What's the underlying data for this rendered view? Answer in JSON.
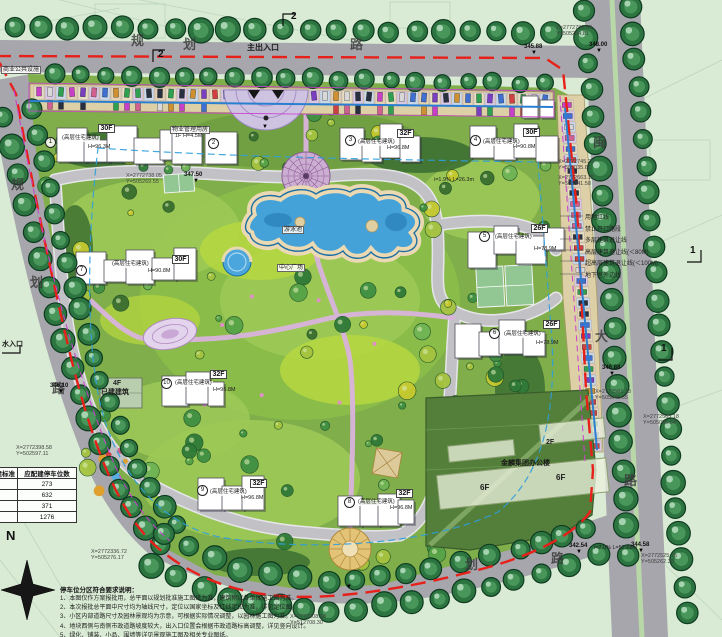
{
  "colors": {
    "boundary_red": "#e8201a",
    "water_blue": "#45a2d8",
    "lawn_green": "#7fae4a",
    "road_gray": "#a6a6ac",
    "tree_green": "#2c7440",
    "path_pink": "#d9b3dc",
    "parcel_green": "#547f3b",
    "setback_blue": "#2f9fdc",
    "magenta_line": "#cc3fd0"
  },
  "legend": {
    "items": [
      "用地红线",
      "禁止开口路段",
      "多层建筑退让线",
      "高层建筑退让线(＜80M)",
      "超高层建筑退让线(＜100M)",
      "地下室外边线"
    ]
  },
  "table": {
    "headers": [
      "配建标准",
      "应配建停车位数"
    ],
    "rows": [
      "273",
      "632",
      "371",
      "1276"
    ]
  },
  "north": {
    "label": "N"
  },
  "notes": {
    "title": "停车位分区符合要求说明：",
    "items": [
      "1、本图仅作方案报批用，总平面以规划批准施工图纸为准，建筑物以各单体施工图为准。",
      "2、本次报批总平面中尺寸均为轴线尺寸，定位以国家坐标及红线定位为准，详见定位图。",
      "3、小区内部道路尺寸及园林景观均为示意，可根据实际情况调整，以园林施工图为准。",
      "4、地块西侧与南侧市政道路坡度较大，出入口位置会根据市政道路标高调整，详见竖向设计。",
      "5、绿化、铺装、小品、围墙等详见景观施工图及相关专业图纸。"
    ]
  },
  "annotations": [
    {
      "t": "规",
      "x": 131,
      "y": 34,
      "c": "char"
    },
    {
      "t": "划",
      "x": 183,
      "y": 38,
      "c": "char"
    },
    {
      "t": "路",
      "x": 350,
      "y": 38,
      "c": "char"
    },
    {
      "t": "规",
      "x": 11,
      "y": 178,
      "c": "char"
    },
    {
      "t": "划",
      "x": 30,
      "y": 276,
      "c": "char"
    },
    {
      "t": "路",
      "x": 52,
      "y": 382,
      "c": "char"
    },
    {
      "t": "闽",
      "x": 593,
      "y": 136,
      "c": "char"
    },
    {
      "t": "大",
      "x": 595,
      "y": 330,
      "c": "char"
    },
    {
      "t": "路",
      "x": 624,
      "y": 474,
      "c": "char"
    },
    {
      "t": "划",
      "x": 465,
      "y": 558,
      "c": "char"
    },
    {
      "t": "路",
      "x": 551,
      "y": 552,
      "c": "char"
    },
    {
      "t": "主出入口",
      "x": 247,
      "y": 44,
      "c": "lab8"
    },
    {
      "t": "水入口",
      "x": 2,
      "y": 341,
      "c": "lab7"
    },
    {
      "t": "商业公共设施",
      "x": 1,
      "y": 66,
      "c": "wl"
    },
    {
      "t": "物业管理用房",
      "x": 170,
      "y": 126,
      "c": "wl"
    },
    {
      "t": "1F H=4.5M",
      "x": 175,
      "y": 134,
      "c": "tiny"
    },
    {
      "t": "游泳池",
      "x": 282,
      "y": 226,
      "c": "wl"
    },
    {
      "t": "中心广场",
      "x": 277,
      "y": 264,
      "c": "wl"
    },
    {
      "t": "已建建筑",
      "x": 101,
      "y": 389,
      "c": "tiny7"
    },
    {
      "t": "4F",
      "x": 113,
      "y": 380,
      "c": "tiny7"
    },
    {
      "t": "2F",
      "x": 546,
      "y": 439,
      "c": "tiny7"
    },
    {
      "t": "金麟集团办公楼",
      "x": 501,
      "y": 460,
      "c": "lab7"
    },
    {
      "t": "6F",
      "x": 556,
      "y": 474,
      "c": "lab8"
    },
    {
      "t": "6F",
      "x": 480,
      "y": 484,
      "c": "lab8"
    },
    {
      "t": "1",
      "x": 45,
      "y": 137,
      "c": "circ"
    },
    {
      "t": "2",
      "x": 208,
      "y": 138,
      "c": "circ"
    },
    {
      "t": "3",
      "x": 345,
      "y": 135,
      "c": "circ"
    },
    {
      "t": "4",
      "x": 470,
      "y": 135,
      "c": "circ"
    },
    {
      "t": "5",
      "x": 479,
      "y": 231,
      "c": "circ"
    },
    {
      "t": "6",
      "x": 489,
      "y": 328,
      "c": "circ"
    },
    {
      "t": "7",
      "x": 76,
      "y": 265,
      "c": "circ"
    },
    {
      "t": "10",
      "x": 161,
      "y": 378,
      "c": "circ"
    },
    {
      "t": "9",
      "x": 197,
      "y": 485,
      "c": "circ"
    },
    {
      "t": "8",
      "x": 344,
      "y": 497,
      "c": "circ"
    },
    {
      "t": "30F",
      "x": 98,
      "y": 124,
      "c": "box"
    },
    {
      "t": "32F",
      "x": 397,
      "y": 129,
      "c": "box"
    },
    {
      "t": "30F",
      "x": 523,
      "y": 128,
      "c": "box"
    },
    {
      "t": "26F",
      "x": 531,
      "y": 224,
      "c": "box"
    },
    {
      "t": "26F",
      "x": 543,
      "y": 320,
      "c": "box"
    },
    {
      "t": "30F",
      "x": 172,
      "y": 255,
      "c": "box"
    },
    {
      "t": "32F",
      "x": 210,
      "y": 370,
      "c": "box"
    },
    {
      "t": "32F",
      "x": 250,
      "y": 479,
      "c": "box"
    },
    {
      "t": "32F",
      "x": 396,
      "y": 489,
      "c": "box"
    },
    {
      "t": "(高层住宅建筑)",
      "x": 61,
      "y": 136,
      "c": "t55"
    },
    {
      "t": "(高层住宅建筑)",
      "x": 357,
      "y": 140,
      "c": "t55"
    },
    {
      "t": "(高层住宅建筑)",
      "x": 482,
      "y": 140,
      "c": "t55"
    },
    {
      "t": "(高层住宅建筑)",
      "x": 494,
      "y": 235,
      "c": "t55"
    },
    {
      "t": "(高层住宅建筑)",
      "x": 503,
      "y": 332,
      "c": "t55"
    },
    {
      "t": "(高层住宅建筑)",
      "x": 111,
      "y": 262,
      "c": "t55"
    },
    {
      "t": "(高层住宅建筑)",
      "x": 174,
      "y": 381,
      "c": "t55"
    },
    {
      "t": "(高层住宅建筑)",
      "x": 209,
      "y": 490,
      "c": "t55"
    },
    {
      "t": "(高层住宅建筑)",
      "x": 357,
      "y": 500,
      "c": "t55"
    },
    {
      "t": "H=96.3M",
      "x": 88,
      "y": 145,
      "c": "tiny"
    },
    {
      "t": "H=96.8M",
      "x": 387,
      "y": 146,
      "c": "tiny"
    },
    {
      "t": "H=90.8M",
      "x": 513,
      "y": 145,
      "c": "tiny"
    },
    {
      "t": "H=78.9M",
      "x": 534,
      "y": 247,
      "c": "tiny"
    },
    {
      "t": "H=78.9M",
      "x": 536,
      "y": 341,
      "c": "tiny"
    },
    {
      "t": "H=90.8M",
      "x": 148,
      "y": 269,
      "c": "tiny"
    },
    {
      "t": "H=96.8M",
      "x": 213,
      "y": 388,
      "c": "tiny"
    },
    {
      "t": "H=96.8M",
      "x": 241,
      "y": 496,
      "c": "tiny"
    },
    {
      "t": "H=96.8M",
      "x": 390,
      "y": 506,
      "c": "tiny"
    },
    {
      "t": "X=2772738.05",
      "x": 126,
      "y": 174,
      "c": "coord"
    },
    {
      "t": "Y=505269.55",
      "x": 126,
      "y": 180,
      "c": "coord"
    },
    {
      "t": "X=2772780.63",
      "x": 556,
      "y": 26,
      "c": "coord"
    },
    {
      "t": "Y=505284.81",
      "x": 556,
      "y": 32,
      "c": "coord"
    },
    {
      "t": "X=2772745.22",
      "x": 558,
      "y": 160,
      "c": "coord"
    },
    {
      "t": "Y=505035.61",
      "x": 558,
      "y": 166,
      "c": "coord"
    },
    {
      "t": "X=2772663.12",
      "x": 558,
      "y": 176,
      "c": "coord"
    },
    {
      "t": "Y=505041.58",
      "x": 558,
      "y": 182,
      "c": "coord"
    },
    {
      "t": "X=2772581.33",
      "x": 595,
      "y": 390,
      "c": "coord"
    },
    {
      "t": "Y=505045.35",
      "x": 595,
      "y": 396,
      "c": "coord"
    },
    {
      "t": "X=2772563.18",
      "x": 643,
      "y": 415,
      "c": "coord"
    },
    {
      "t": "Y=505050.64",
      "x": 643,
      "y": 421,
      "c": "coord"
    },
    {
      "t": "X=2772398.58",
      "x": 16,
      "y": 446,
      "c": "coord"
    },
    {
      "t": "Y=502597.11",
      "x": 16,
      "y": 452,
      "c": "coord"
    },
    {
      "t": "X=2772336.72",
      "x": 91,
      "y": 550,
      "c": "coord"
    },
    {
      "t": "Y=505276.17",
      "x": 91,
      "y": 556,
      "c": "coord"
    },
    {
      "t": "X=2772208.58",
      "x": 290,
      "y": 615,
      "c": "coord"
    },
    {
      "t": "Y=512708.30",
      "x": 290,
      "y": 621,
      "c": "coord"
    },
    {
      "t": "X=2772525.75",
      "x": 641,
      "y": 554,
      "c": "coord"
    },
    {
      "t": "Y=505262.38",
      "x": 641,
      "y": 560,
      "c": "coord"
    },
    {
      "t": "347.50",
      "x": 184,
      "y": 172,
      "c": "elev"
    },
    {
      "t": "348.00",
      "x": 589,
      "y": 42,
      "c": "elev"
    },
    {
      "t": "345.88",
      "x": 524,
      "y": 44,
      "c": "elev"
    },
    {
      "t": "346.88",
      "x": 602,
      "y": 365,
      "c": "elev"
    },
    {
      "t": "344.58",
      "x": 631,
      "y": 542,
      "c": "elev"
    },
    {
      "t": "342.54",
      "x": 569,
      "y": 543,
      "c": "elev"
    },
    {
      "t": "346.10",
      "x": 50,
      "y": 383,
      "c": "elev"
    },
    {
      "t": "▼",
      "x": 193,
      "y": 178,
      "c": "tri"
    },
    {
      "t": "▼",
      "x": 596,
      "y": 48,
      "c": "tri"
    },
    {
      "t": "▼",
      "x": 531,
      "y": 50,
      "c": "tri"
    },
    {
      "t": "▼",
      "x": 609,
      "y": 371,
      "c": "tri"
    },
    {
      "t": "▼",
      "x": 638,
      "y": 548,
      "c": "tri"
    },
    {
      "t": "▼",
      "x": 576,
      "y": 549,
      "c": "tri"
    },
    {
      "t": "▼",
      "x": 58,
      "y": 389,
      "c": "tri"
    },
    {
      "t": "▼",
      "x": 262,
      "y": 124,
      "c": "tri"
    },
    {
      "t": "▼",
      "x": 346,
      "y": 584,
      "c": "tri"
    },
    {
      "t": "i=2.0% L=52.68m",
      "x": 594,
      "y": 546,
      "c": "tiny"
    },
    {
      "t": "i=1.9% L=26.3m",
      "x": 434,
      "y": 178,
      "c": "tiny"
    },
    {
      "t": "2",
      "x": 291,
      "y": 12,
      "c": "sec"
    },
    {
      "t": "2",
      "x": 158,
      "y": 50,
      "c": "sec"
    },
    {
      "t": "1",
      "x": 690,
      "y": 246,
      "c": "sec"
    },
    {
      "t": "1",
      "x": 661,
      "y": 344,
      "c": "sec"
    }
  ]
}
